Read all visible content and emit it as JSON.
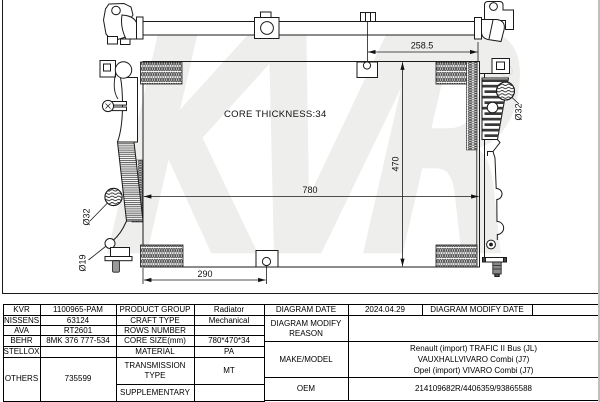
{
  "diagram": {
    "watermark": "KVR",
    "registered_mark": "®",
    "core_thickness_note": "CORE THICKNESS:34",
    "dim_top_pipe_offset": "258.5",
    "dim_core_width": "780",
    "dim_core_height": "470",
    "dim_bottom_bracket_offset": "290",
    "dim_right_outlet": "Ø32",
    "dim_left_outlet": "Ø32",
    "dim_left_drain": "Ø19"
  },
  "table": {
    "left_rows": [
      {
        "brand": "KVR",
        "number": "1100965-PAM",
        "label": "PRODUCT GROUP",
        "value": "Radiator"
      },
      {
        "brand": "NISSENS",
        "number": "63124",
        "label": "CRAFT TYPE",
        "value": "Mechanical"
      },
      {
        "brand": "AVA",
        "number": "RT2601",
        "label": "ROWS NUMBER",
        "value": ""
      },
      {
        "brand": "BEHR",
        "number": "8MK 376 777-534",
        "label": "CORE SIZE(mm)",
        "value": "780*470*34"
      },
      {
        "brand": "STELLOX",
        "number": "",
        "label": "MATERIAL",
        "value": "PA"
      },
      {
        "brand": "OTHERS",
        "number": "735599",
        "label": "TRANSMISSION TYPE",
        "value": "MT"
      },
      {
        "label": "SUPPLEMENTARY",
        "value": ""
      }
    ],
    "right": {
      "diagram_date_label": "DIAGRAM DATE",
      "diagram_date_value": "2024.04.29",
      "diagram_modify_date_label": "DIAGRAM MODIFY DATE",
      "diagram_modify_date_value": "",
      "modify_reason_label": "DIAGRAM MODIFY REASON",
      "modify_reason_value": "",
      "make_model_label": "MAKE/MODEL",
      "make_model_lines": [
        "Renault (import) TRAFIC II Bus (JL)",
        "VAUXHALLVIVARO Combi (J7)",
        "Opel (import) VIVARO Combi (J7)"
      ],
      "oem_label": "OEM",
      "oem_value": "214109682R/4406359/93865588"
    }
  }
}
